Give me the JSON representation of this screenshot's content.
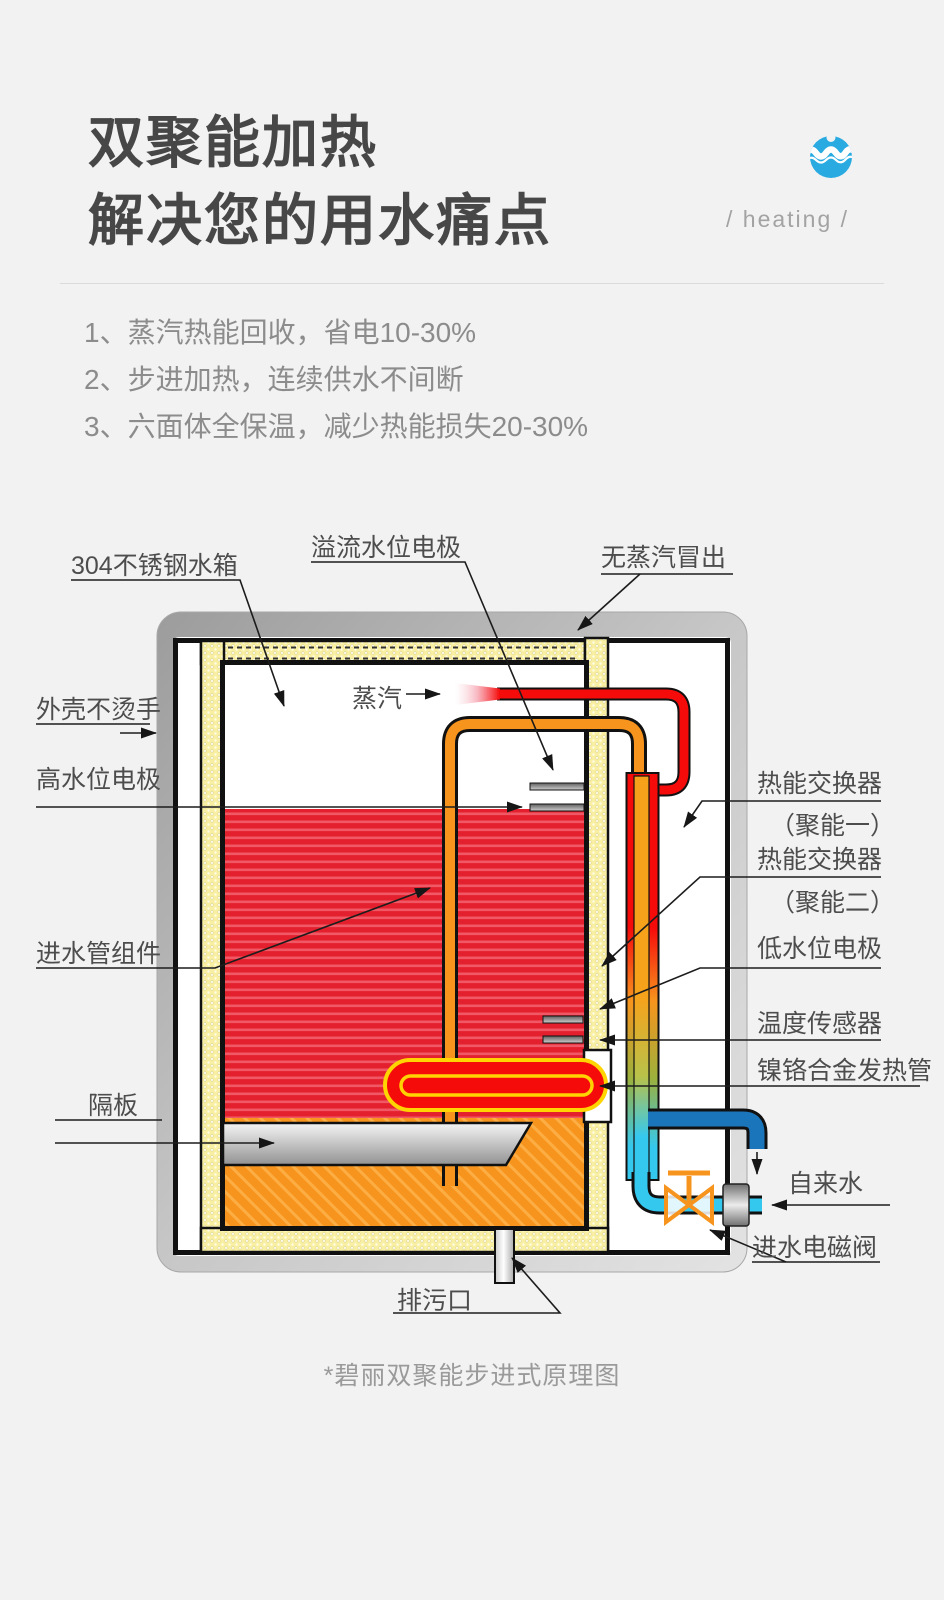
{
  "header": {
    "title_line1": "双聚能加热",
    "title_line2": "解决您的用水痛点",
    "tagline": "/ heating /",
    "icon": "water-cup-icon"
  },
  "features": {
    "items": [
      "1、蒸汽热能回收，省电10-30%",
      "2、步进加热，连续供水不间断",
      "3、六面体全保温，减少热能损失20-30%"
    ]
  },
  "diagram": {
    "labels": {
      "tank": "304不锈钢水箱",
      "overflow_electrode": "溢流水位电极",
      "no_steam": "无蒸汽冒出",
      "steam": "蒸汽",
      "cool_shell": "外壳不烫手",
      "high_electrode": "高水位电极",
      "hx1_line1": "热能交换器",
      "hx1_line2": "（聚能一）",
      "hx2_line1": "热能交换器",
      "hx2_line2": "（聚能二）",
      "low_electrode": "低水位电极",
      "temp_sensor": "温度传感器",
      "heater_tube": "镍铬合金发热管",
      "inlet_assembly": "进水管组件",
      "baffle": "隔板",
      "drain": "排污口",
      "tap_water": "自来水",
      "inlet_valve": "进水电磁阀"
    },
    "caption": "*碧丽双聚能步进式原理图",
    "colors": {
      "hot_water": "#e4202e",
      "inlet_pipe": "#f7941d",
      "steam_pipe": "#f60b0b",
      "cold_pipe": "#35c8ef",
      "outlet_pipe": "#1b75bb",
      "insulation": "#f9f0a3",
      "brand_blue": "#29abe2"
    }
  }
}
